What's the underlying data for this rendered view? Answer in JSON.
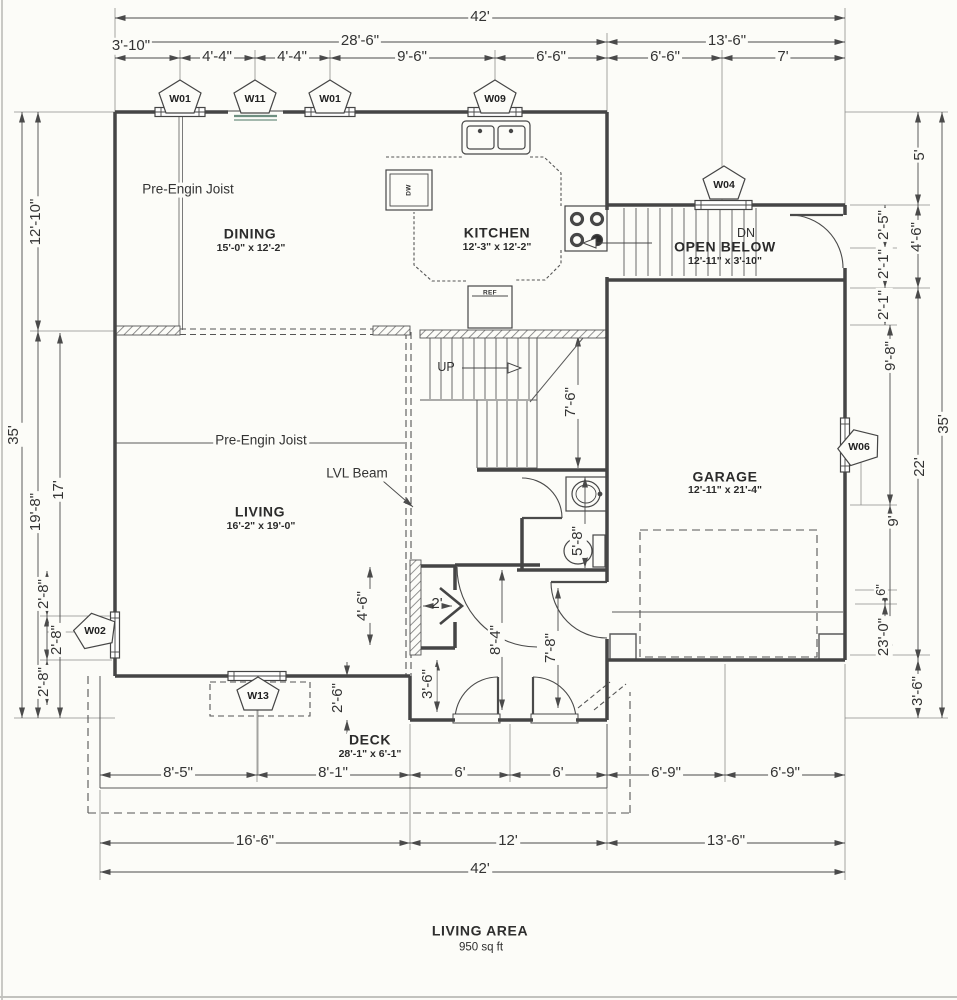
{
  "plan": {
    "rooms": {
      "dining": {
        "name": "DINING",
        "size": "15'-0\" x 12'-2\""
      },
      "kitchen": {
        "name": "KITCHEN",
        "size": "12'-3\" x 12'-2\""
      },
      "open_below": {
        "name": "OPEN BELOW",
        "size": "12'-11\" x 3'-10\""
      },
      "living": {
        "name": "LIVING",
        "size": "16'-2\" x 19'-0\""
      },
      "garage": {
        "name": "GARAGE",
        "size": "12'-11\" x 21'-4\""
      },
      "deck": {
        "name": "DECK",
        "size": "28'-1\" x 6'-1\""
      }
    },
    "notes": {
      "joist_dining": "Pre-Engin Joist",
      "joist_living": "Pre-Engin Joist",
      "lvl_beam": "LVL Beam",
      "up": "UP",
      "dn": "DN",
      "dw": "DW",
      "ref": "REF"
    },
    "window_tags": {
      "w01a": "W01",
      "w11": "W11",
      "w01b": "W01",
      "w09": "W09",
      "w04": "W04",
      "w06": "W06",
      "w02": "W02",
      "w13": "W13"
    },
    "dims": {
      "top": {
        "total": "42'",
        "left_span": "28'-6\"",
        "right_span": "13'-6\"",
        "d1": "3'-10\"",
        "d2": "4'-4\"",
        "d3": "4'-4\"",
        "d4": "9'-6\"",
        "d5": "6'-6\"",
        "d6": "6'-6\"",
        "d7": "7'"
      },
      "bottom": {
        "d1": "8'-5\"",
        "d2": "8'-1\"",
        "d3": "6'",
        "d4": "6'",
        "d5": "6'-9\"",
        "d6": "6'-9\"",
        "left_span": "16'-6\"",
        "mid_span": "12'",
        "right_span": "13'-6\"",
        "total": "42'"
      },
      "left": {
        "total": "35'",
        "d1": "12'-10\"",
        "d2": "19'-8\"",
        "d3": "17'",
        "d4": "2'-8\"",
        "d5": "2'-8\"",
        "d6": "2'-8\""
      },
      "right": {
        "total": "35'",
        "d1": "5'",
        "d2": "2'-5\"",
        "d3": "4'-6\"",
        "d4": "2'-1\"",
        "d5": "2'-1\"",
        "d6": "9'-8\"",
        "d7": "22'",
        "d8": "9'",
        "d9": "6\"",
        "d10": "23'-0\"",
        "d11": "3'-6\""
      },
      "interior": {
        "stair": "7'-6\"",
        "bath": "5'-8\"",
        "closet_h": "4'-6\"",
        "closet_w": "2'",
        "entry_side": "3'-6\"",
        "entry_mid": "8'-4\"",
        "entry_right": "7'-8\"",
        "deck_step": "2'-6\""
      }
    },
    "footer": {
      "title": "LIVING AREA",
      "area": "950 sq ft"
    }
  }
}
